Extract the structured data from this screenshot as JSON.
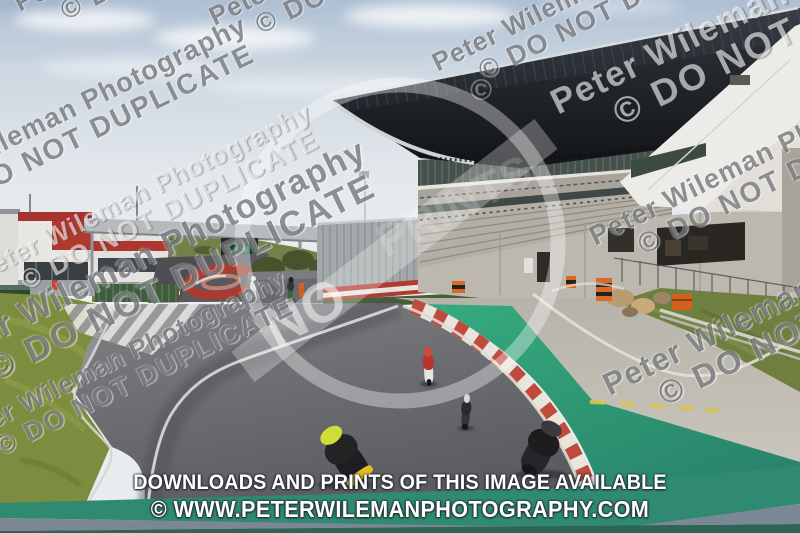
{
  "watermark": {
    "line1": "Peter Wileman Photography",
    "line2": "© DO NOT DUPLICATE",
    "angle_deg": -26,
    "instances": [
      {
        "x": 10,
        "y": -8,
        "s": 1.0,
        "light": false
      },
      {
        "x": 205,
        "y": 6,
        "s": 1.0,
        "light": false
      },
      {
        "x": 262,
        "y": -34,
        "s": 1.0,
        "light": false
      },
      {
        "x": 428,
        "y": 52,
        "s": 1.0,
        "light": false
      },
      {
        "x": 545,
        "y": 88,
        "s": 1.35,
        "light": true
      },
      {
        "x": 648,
        "y": -30,
        "s": 1.0,
        "light": false
      },
      {
        "x": -112,
        "y": 182,
        "s": 1.05,
        "light": false
      },
      {
        "x": -30,
        "y": 262,
        "s": 1.0,
        "light": true
      },
      {
        "x": 585,
        "y": 225,
        "s": 1.05,
        "light": false
      },
      {
        "x": -78,
        "y": 345,
        "s": 1.3,
        "light": false
      },
      {
        "x": 598,
        "y": 372,
        "s": 1.2,
        "light": false
      },
      {
        "x": -55,
        "y": 428,
        "s": 1.0,
        "light": false
      }
    ],
    "stamp": {
      "no": "NO",
      "prints": "PRINTS",
      "copyright": "©"
    }
  },
  "banner": {
    "line1": "DOWNLOADS AND PRINTS OF THIS IMAGE AVAILABLE",
    "line2": "© WWW.PETERWILEMANPHOTOGRAPHY.COM"
  },
  "colors": {
    "banner_text": "#ffffff",
    "runoff_green": "#34a87d",
    "runoff_teal": "#2b8a70",
    "curb_red": "#c04a3c",
    "curb_white": "#e9e4dc",
    "grass": "#7d8d3f",
    "sky_top": "#aebfd3",
    "roof_dark": "#1a1d21",
    "building_red": "#a8332e"
  },
  "riders": [
    {
      "x": 247,
      "y": 276,
      "w": 13,
      "h": 25,
      "lean": 0,
      "suit": "#d4d4d2",
      "bike": "#bdbdbb",
      "helmet": "#e8e8e6",
      "tail": ""
    },
    {
      "x": 284,
      "y": 277,
      "w": 13,
      "h": 24,
      "lean": 3,
      "suit": "#36363a",
      "bike": "#2e6b38",
      "helmet": "#232326",
      "tail": ""
    },
    {
      "x": 419,
      "y": 348,
      "w": 19,
      "h": 37,
      "lean": -2,
      "suit": "#b8352f",
      "bike": "#e6e4e0",
      "helmet": "#d7453c",
      "tail": ""
    },
    {
      "x": 457,
      "y": 395,
      "w": 18,
      "h": 34,
      "lean": 4,
      "suit": "#2a2a2e",
      "bike": "#333338",
      "helmet": "#d8d8d6",
      "tail": ""
    },
    {
      "x": 314,
      "y": 424,
      "w": 62,
      "h": 62,
      "lean": -35,
      "suit": "#232326",
      "bike": "#1e1e22",
      "helmet": "#cfdc3a",
      "tail": "#e0c020"
    },
    {
      "x": 512,
      "y": 420,
      "w": 58,
      "h": 56,
      "lean": 28,
      "suit": "#1d1d20",
      "bike": "#26262a",
      "helmet": "#3a3a3e",
      "tail": ""
    }
  ]
}
